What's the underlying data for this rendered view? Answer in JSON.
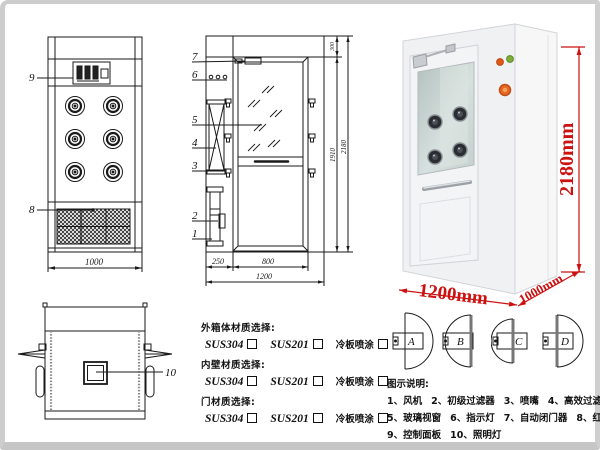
{
  "front_view": {
    "callout_control_panel": "9",
    "callout_grille": "8",
    "width_dim": "1000"
  },
  "side_view": {
    "callouts": [
      "1",
      "2",
      "3",
      "4",
      "5",
      "6",
      "7"
    ],
    "dim_left": "250",
    "dim_door": "800",
    "dim_total_width": "1200",
    "dim_top": "300",
    "dim_door_height": "1910",
    "dim_total_height": "2180"
  },
  "top_view": {
    "callout_window": "10"
  },
  "photo": {
    "height_label": "2180mm",
    "width_label": "1200mm",
    "depth_label": "1000mm",
    "dim_color": "#cc1111"
  },
  "materials": {
    "rows": [
      {
        "label": "外箱体材质选择:",
        "options": [
          "SUS304",
          "SUS201",
          "冷板喷涂"
        ]
      },
      {
        "label": "内壁材质选择:",
        "options": [
          "SUS304",
          "SUS201",
          "冷板喷涂"
        ]
      },
      {
        "label": "门材质选择:",
        "options": [
          "SUS304",
          "SUS201",
          "冷板喷涂"
        ]
      }
    ]
  },
  "door_options": {
    "labels": [
      "A",
      "B",
      "C",
      "D"
    ]
  },
  "legend": {
    "title": "图示说明:",
    "items": [
      "1、风机",
      "2、初级过滤器",
      "3、喷嘴",
      "4、高效过滤器",
      "5、玻璃视窗",
      "6、指示灯",
      "7、自动闭门器",
      "8、红外线感应器",
      "9、控制面板",
      "10、照明灯"
    ]
  }
}
